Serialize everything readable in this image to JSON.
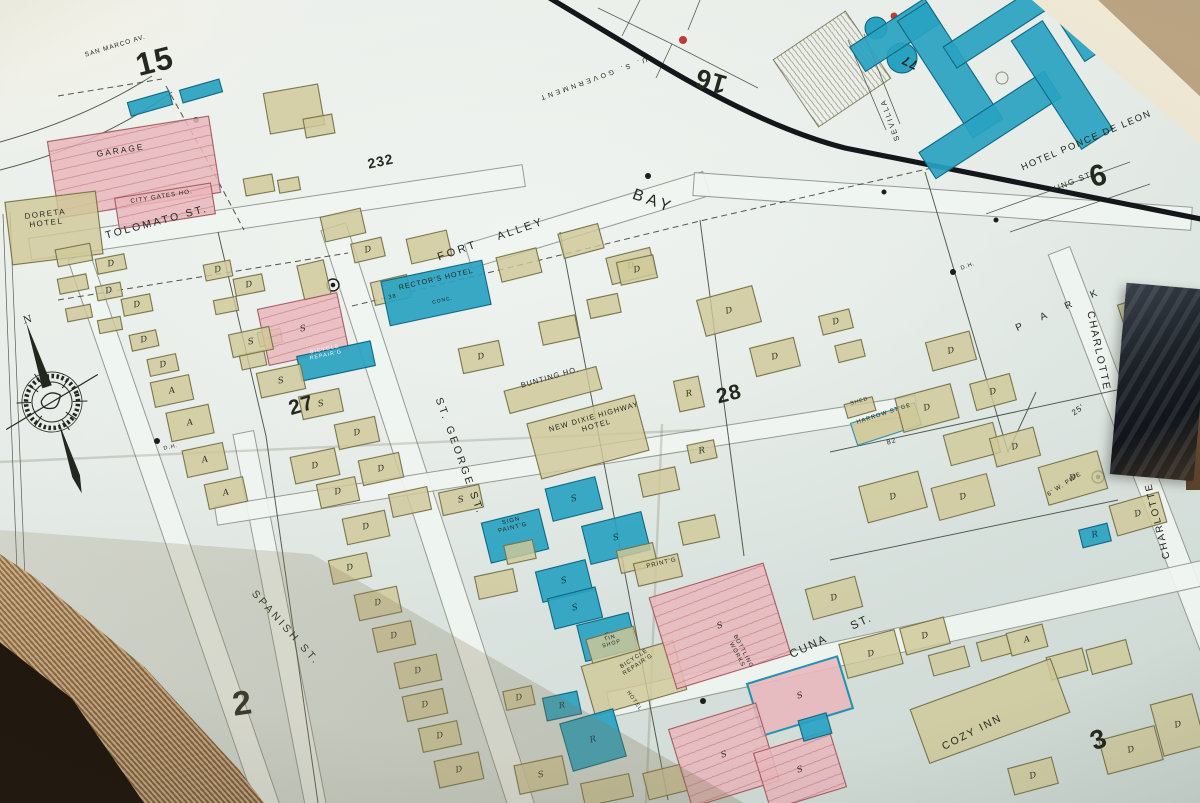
{
  "palette": {
    "paper": "#e2e9e5",
    "tan_building": "#d0c898",
    "pink_building": "#e9b8bd",
    "blue_building": "#29a2c1",
    "ink": "#24291f",
    "boundary_black": "#14161a",
    "table_wood": "#20170e",
    "page_edge_tan": "#a8845c"
  },
  "sheet_numbers": {
    "n15": "15",
    "n16": "16",
    "n6": "6",
    "n77": "77",
    "n232": "232",
    "n27": "27",
    "n28": "28",
    "n2": "2",
    "n3": "3"
  },
  "streets": {
    "san_marco": "SAN MARCO AV.",
    "tolomato": "TOLOMATO ST.",
    "fort_alley": "FORT ALLEY",
    "bay": "BAY",
    "st_george": "ST. GEORGE ST.",
    "spanish": "SPANISH ST.",
    "cuna": "CUNA ST.",
    "charlotte": "CHARLOTTE",
    "park": "P A R K",
    "king": "KING ST.",
    "sevilla": "SEVILLA",
    "us_government": "U. S. GOVERNMENT"
  },
  "places": {
    "garage": "GARAGE",
    "city_gates": "CITY GATES HO.",
    "doreta": "DORETA\nHOTEL",
    "rectors": "RECTOR'S HOTEL",
    "bunting": "BUNTING HO.",
    "new_dixie": "NEW DIXIE HIGHWAY\nHOTEL",
    "shed": "SHED",
    "harrow": "HARROW ST'GE",
    "bottling": "BOTTLING\nWORKS",
    "printing": "PRINT'G",
    "sign_painting": "SIGN\nPAINT'G",
    "tin_shop": "TIN\nSHOP",
    "bicycle_repair": "BICYCLE\nREPAIR'G",
    "cozy_inn": "COZY INN",
    "ponce": "HOTEL PONCE DE LEON",
    "hotel_vertical": "HOTEL"
  },
  "annotations": {
    "dh": "D.H.",
    "w_pipe": "6' W. PIPE",
    "dim_25": "25'",
    "lot_38": "38",
    "lot_82": "82",
    "conc": "CONC.",
    "north": "N"
  },
  "buildings": [
    [
      128,
      96,
      44,
      15,
      -16,
      "b",
      ""
    ],
    [
      180,
      84,
      42,
      14,
      -16,
      "b",
      ""
    ],
    [
      266,
      88,
      56,
      42,
      -10,
      "t",
      ""
    ],
    [
      304,
      116,
      30,
      20,
      -10,
      "t",
      ""
    ],
    [
      244,
      176,
      30,
      18,
      -10,
      "t",
      ""
    ],
    [
      278,
      178,
      22,
      14,
      -10,
      "t",
      ""
    ],
    [
      52,
      128,
      164,
      78,
      -9,
      "p",
      ""
    ],
    [
      116,
      190,
      98,
      32,
      -9,
      "p",
      ""
    ],
    [
      8,
      196,
      92,
      64,
      -7,
      "t",
      ""
    ],
    [
      56,
      246,
      36,
      18,
      -11,
      "t",
      ""
    ],
    [
      96,
      256,
      30,
      16,
      -11,
      "t",
      "D"
    ],
    [
      58,
      276,
      30,
      16,
      -11,
      "t",
      ""
    ],
    [
      96,
      284,
      26,
      15,
      -11,
      "t",
      "D"
    ],
    [
      122,
      296,
      30,
      18,
      -11,
      "t",
      "D"
    ],
    [
      66,
      306,
      26,
      14,
      -11,
      "t",
      ""
    ],
    [
      98,
      318,
      24,
      14,
      -11,
      "t",
      ""
    ],
    [
      204,
      262,
      28,
      17,
      -11,
      "t",
      "D"
    ],
    [
      234,
      276,
      30,
      18,
      -11,
      "t",
      "D"
    ],
    [
      214,
      298,
      24,
      15,
      -11,
      "t",
      ""
    ],
    [
      130,
      332,
      28,
      17,
      -12,
      "t",
      "D"
    ],
    [
      148,
      356,
      30,
      18,
      -12,
      "t",
      "D"
    ],
    [
      152,
      378,
      40,
      26,
      -12,
      "t",
      "A"
    ],
    [
      168,
      408,
      44,
      30,
      -12,
      "t",
      "A"
    ],
    [
      184,
      446,
      42,
      28,
      -12,
      "t",
      "A"
    ],
    [
      206,
      480,
      40,
      26,
      -12,
      "t",
      "A"
    ],
    [
      240,
      352,
      26,
      16,
      -12,
      "t",
      ""
    ],
    [
      258,
      330,
      24,
      15,
      -12,
      "t",
      ""
    ],
    [
      322,
      212,
      42,
      26,
      -13,
      "t",
      ""
    ],
    [
      352,
      240,
      32,
      20,
      -13,
      "t",
      "D"
    ],
    [
      408,
      234,
      42,
      26,
      -13,
      "t",
      ""
    ],
    [
      372,
      278,
      38,
      24,
      -13,
      "t",
      ""
    ],
    [
      300,
      262,
      28,
      36,
      -13,
      "t",
      ""
    ],
    [
      384,
      270,
      104,
      46,
      -12,
      "b",
      ""
    ],
    [
      498,
      252,
      42,
      26,
      -14,
      "t",
      ""
    ],
    [
      560,
      228,
      42,
      26,
      -15,
      "t",
      ""
    ],
    [
      608,
      252,
      46,
      28,
      -14,
      "t",
      "D"
    ],
    [
      700,
      292,
      58,
      38,
      -15,
      "t",
      "D"
    ],
    [
      752,
      342,
      46,
      30,
      -14,
      "t",
      "D"
    ],
    [
      820,
      312,
      32,
      20,
      -14,
      "t",
      "D"
    ],
    [
      836,
      342,
      28,
      18,
      -14,
      "t",
      ""
    ],
    [
      928,
      336,
      46,
      30,
      -15,
      "t",
      "D"
    ],
    [
      972,
      378,
      42,
      28,
      -15,
      "t",
      "D"
    ],
    [
      262,
      300,
      82,
      58,
      -12,
      "p",
      "S"
    ],
    [
      298,
      348,
      76,
      26,
      -12,
      "b",
      ""
    ],
    [
      230,
      330,
      42,
      24,
      -12,
      "t",
      "S"
    ],
    [
      258,
      368,
      46,
      26,
      -12,
      "t",
      "S"
    ],
    [
      300,
      392,
      42,
      24,
      -12,
      "t",
      "S"
    ],
    [
      336,
      420,
      42,
      26,
      -12,
      "t",
      "D"
    ],
    [
      292,
      452,
      46,
      28,
      -12,
      "t",
      "D"
    ],
    [
      360,
      456,
      42,
      26,
      -12,
      "t",
      "D"
    ],
    [
      390,
      490,
      40,
      24,
      -12,
      "t",
      ""
    ],
    [
      460,
      344,
      42,
      26,
      -12,
      "t",
      "D"
    ],
    [
      540,
      318,
      38,
      24,
      -12,
      "t",
      ""
    ],
    [
      588,
      296,
      32,
      20,
      -12,
      "t",
      ""
    ],
    [
      618,
      258,
      38,
      24,
      -12,
      "t",
      "D"
    ],
    [
      505,
      378,
      96,
      24,
      -15,
      "t",
      ""
    ],
    [
      532,
      408,
      112,
      58,
      -15,
      "t",
      ""
    ],
    [
      676,
      378,
      26,
      32,
      -12,
      "t",
      "R"
    ],
    [
      688,
      442,
      28,
      19,
      -12,
      "t",
      "R"
    ],
    [
      845,
      400,
      30,
      15,
      -16,
      "t",
      ""
    ],
    [
      852,
      412,
      68,
      24,
      -18,
      "tb",
      ""
    ],
    [
      898,
      390,
      58,
      36,
      -15,
      "t",
      "D"
    ],
    [
      946,
      428,
      52,
      32,
      -15,
      "t",
      ""
    ],
    [
      992,
      432,
      46,
      30,
      -15,
      "t",
      "D"
    ],
    [
      862,
      478,
      62,
      38,
      -15,
      "t",
      "D"
    ],
    [
      934,
      480,
      58,
      34,
      -15,
      "t",
      "D"
    ],
    [
      1042,
      458,
      62,
      40,
      -16,
      "t",
      "D"
    ],
    [
      1112,
      498,
      52,
      32,
      -16,
      "t",
      "D"
    ],
    [
      1080,
      526,
      30,
      19,
      -14,
      "b",
      "R"
    ],
    [
      1120,
      298,
      40,
      26,
      -18,
      "t",
      "D"
    ],
    [
      1144,
      388,
      36,
      24,
      -18,
      "t",
      "D"
    ],
    [
      440,
      488,
      42,
      24,
      -12,
      "t",
      "S"
    ],
    [
      485,
      515,
      60,
      42,
      -14,
      "b",
      ""
    ],
    [
      548,
      482,
      52,
      34,
      -14,
      "b",
      "S"
    ],
    [
      585,
      518,
      62,
      40,
      -14,
      "b",
      "S"
    ],
    [
      538,
      565,
      52,
      32,
      -14,
      "b",
      "S"
    ],
    [
      550,
      592,
      50,
      32,
      -14,
      "b",
      "S"
    ],
    [
      580,
      618,
      54,
      38,
      -14,
      "b",
      "S"
    ],
    [
      505,
      542,
      30,
      20,
      -12,
      "t",
      ""
    ],
    [
      476,
      572,
      40,
      24,
      -12,
      "t",
      ""
    ],
    [
      618,
      546,
      38,
      24,
      -13,
      "t",
      ""
    ],
    [
      635,
      558,
      46,
      24,
      -13,
      "t",
      ""
    ],
    [
      680,
      518,
      38,
      24,
      -12,
      "t",
      ""
    ],
    [
      640,
      470,
      38,
      24,
      -12,
      "t",
      ""
    ],
    [
      318,
      480,
      40,
      25,
      -12,
      "t",
      "D"
    ],
    [
      344,
      514,
      44,
      27,
      -12,
      "t",
      "D"
    ],
    [
      330,
      556,
      40,
      25,
      -12,
      "t",
      "D"
    ],
    [
      356,
      590,
      44,
      27,
      -12,
      "t",
      "D"
    ],
    [
      374,
      624,
      40,
      25,
      -12,
      "t",
      "D"
    ],
    [
      396,
      658,
      44,
      27,
      -12,
      "t",
      "D"
    ],
    [
      404,
      692,
      42,
      26,
      -12,
      "t",
      "D"
    ],
    [
      420,
      724,
      40,
      25,
      -12,
      "t",
      "D"
    ],
    [
      436,
      756,
      46,
      28,
      -12,
      "t",
      "D"
    ],
    [
      588,
      632,
      50,
      26,
      -16,
      "t",
      ""
    ],
    [
      586,
      652,
      96,
      52,
      -16,
      "t",
      ""
    ],
    [
      544,
      694,
      36,
      24,
      -12,
      "b",
      "R"
    ],
    [
      565,
      715,
      56,
      50,
      -16,
      "b",
      "R"
    ],
    [
      504,
      688,
      30,
      20,
      -12,
      "t",
      "D"
    ],
    [
      516,
      760,
      50,
      30,
      -12,
      "t",
      "S"
    ],
    [
      582,
      778,
      50,
      24,
      -12,
      "t",
      ""
    ],
    [
      645,
      768,
      40,
      28,
      -14,
      "t",
      ""
    ],
    [
      660,
      578,
      120,
      96,
      -17,
      "p",
      "S"
    ],
    [
      752,
      668,
      96,
      56,
      -17,
      "pb",
      "S"
    ],
    [
      678,
      714,
      92,
      82,
      -17,
      "p",
      "S"
    ],
    [
      760,
      740,
      80,
      60,
      -17,
      "p",
      "S"
    ],
    [
      800,
      716,
      30,
      22,
      -16,
      "b",
      ""
    ],
    [
      842,
      636,
      58,
      36,
      -15,
      "t",
      "D"
    ],
    [
      902,
      622,
      46,
      28,
      -15,
      "t",
      "D"
    ],
    [
      930,
      650,
      38,
      22,
      -15,
      "t",
      ""
    ],
    [
      978,
      638,
      32,
      20,
      -15,
      "t",
      ""
    ],
    [
      1008,
      628,
      38,
      24,
      -15,
      "t",
      "A"
    ],
    [
      1048,
      652,
      38,
      24,
      -15,
      "t",
      ""
    ],
    [
      1088,
      644,
      42,
      26,
      -15,
      "t",
      ""
    ],
    [
      915,
      682,
      150,
      58,
      -20,
      "t",
      ""
    ],
    [
      1102,
      732,
      58,
      36,
      -15,
      "t",
      "D"
    ],
    [
      1156,
      698,
      44,
      54,
      -15,
      "t",
      "D"
    ],
    [
      1010,
      762,
      46,
      28,
      -15,
      "t",
      "D"
    ],
    [
      808,
      582,
      52,
      32,
      -15,
      "t",
      "D"
    ],
    [
      850,
      20,
      90,
      30,
      -33,
      "b",
      ""
    ],
    [
      932,
      0,
      36,
      140,
      -33,
      "b",
      ""
    ],
    [
      915,
      109,
      150,
      32,
      -33,
      "b",
      ""
    ],
    [
      1043,
      20,
      38,
      130,
      -33,
      "b",
      ""
    ],
    [
      1068,
      6,
      44,
      48,
      -33,
      "b",
      ""
    ],
    [
      940,
      12,
      120,
      26,
      -33,
      "b",
      ""
    ]
  ]
}
